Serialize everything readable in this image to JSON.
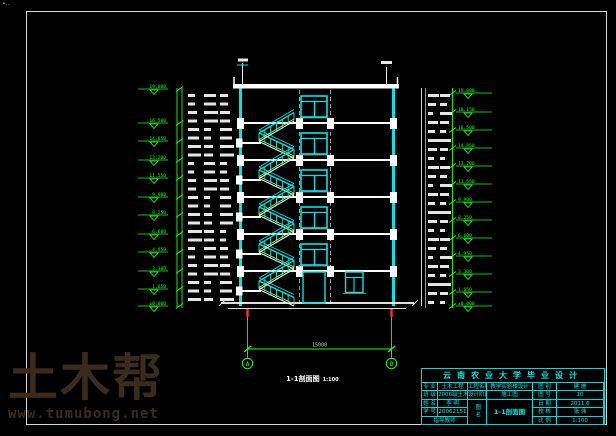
{
  "sheet": {
    "corner_mark": "∙‥"
  },
  "watermark": {
    "brand": "土木帮",
    "url": "www.tumubong.net",
    "color": "#3b2b1d"
  },
  "drawing": {
    "section_title": "1-1剖面图",
    "section_scale": "1:100",
    "bottom_dim": "15000",
    "axis_bubbles": [
      "A",
      "D"
    ],
    "colors": {
      "cyan": "#00e6e6",
      "green": "#19ff19",
      "white": "#e9e9e9",
      "stair_yellow": "#c9f51e",
      "tick_red": "#ff2a2a",
      "dim_gray": "#bdbdbd"
    },
    "elevations_left": [
      {
        "y": 89,
        "v": "19.800"
      },
      {
        "y": 123,
        "v": "16.500"
      },
      {
        "y": 141,
        "v": "14.850"
      },
      {
        "y": 160,
        "v": "13.200"
      },
      {
        "y": 178,
        "v": "11.550"
      },
      {
        "y": 197,
        "v": "9.900"
      },
      {
        "y": 215,
        "v": "8.250"
      },
      {
        "y": 234,
        "v": "6.600"
      },
      {
        "y": 252,
        "v": "4.950"
      },
      {
        "y": 271,
        "v": "3.300"
      },
      {
        "y": 289,
        "v": "1.650"
      },
      {
        "y": 306,
        "v": "±0.000"
      }
    ],
    "elevations_right": [
      {
        "y": 93,
        "v": "19.800"
      },
      {
        "y": 112,
        "v": "18.150"
      },
      {
        "y": 130,
        "v": "16.500"
      },
      {
        "y": 148,
        "v": "14.850"
      },
      {
        "y": 166,
        "v": "13.200"
      },
      {
        "y": 184,
        "v": "11.550"
      },
      {
        "y": 202,
        "v": "9.900"
      },
      {
        "y": 220,
        "v": "8.250"
      },
      {
        "y": 238,
        "v": "6.600"
      },
      {
        "y": 256,
        "v": "4.950"
      },
      {
        "y": 274,
        "v": "3.300"
      },
      {
        "y": 292,
        "v": "1.650"
      },
      {
        "y": 306,
        "v": "±0.000"
      }
    ]
  },
  "titleblock": {
    "header": "云南农业大学毕业设计",
    "left_labels": [
      "专 业",
      "班 级",
      "姓 名",
      "学 号"
    ],
    "left_values": [
      "土木工程",
      "2006级土木",
      "李 明",
      "20062151"
    ],
    "advisor_label": "指导教师",
    "mid_labels": [
      "工程名称",
      "设计阶段"
    ],
    "mid_values": [
      "教学实验楼设计",
      "施工图"
    ],
    "fig_name_label": "图名",
    "fig_name": "1-1剖面图",
    "right_labels": [
      "图 别",
      "图 号",
      "日 期",
      "校 核",
      "比 例"
    ],
    "right_values": [
      "建 施",
      "10",
      "2011.6",
      "张 伟",
      "1:100"
    ]
  }
}
